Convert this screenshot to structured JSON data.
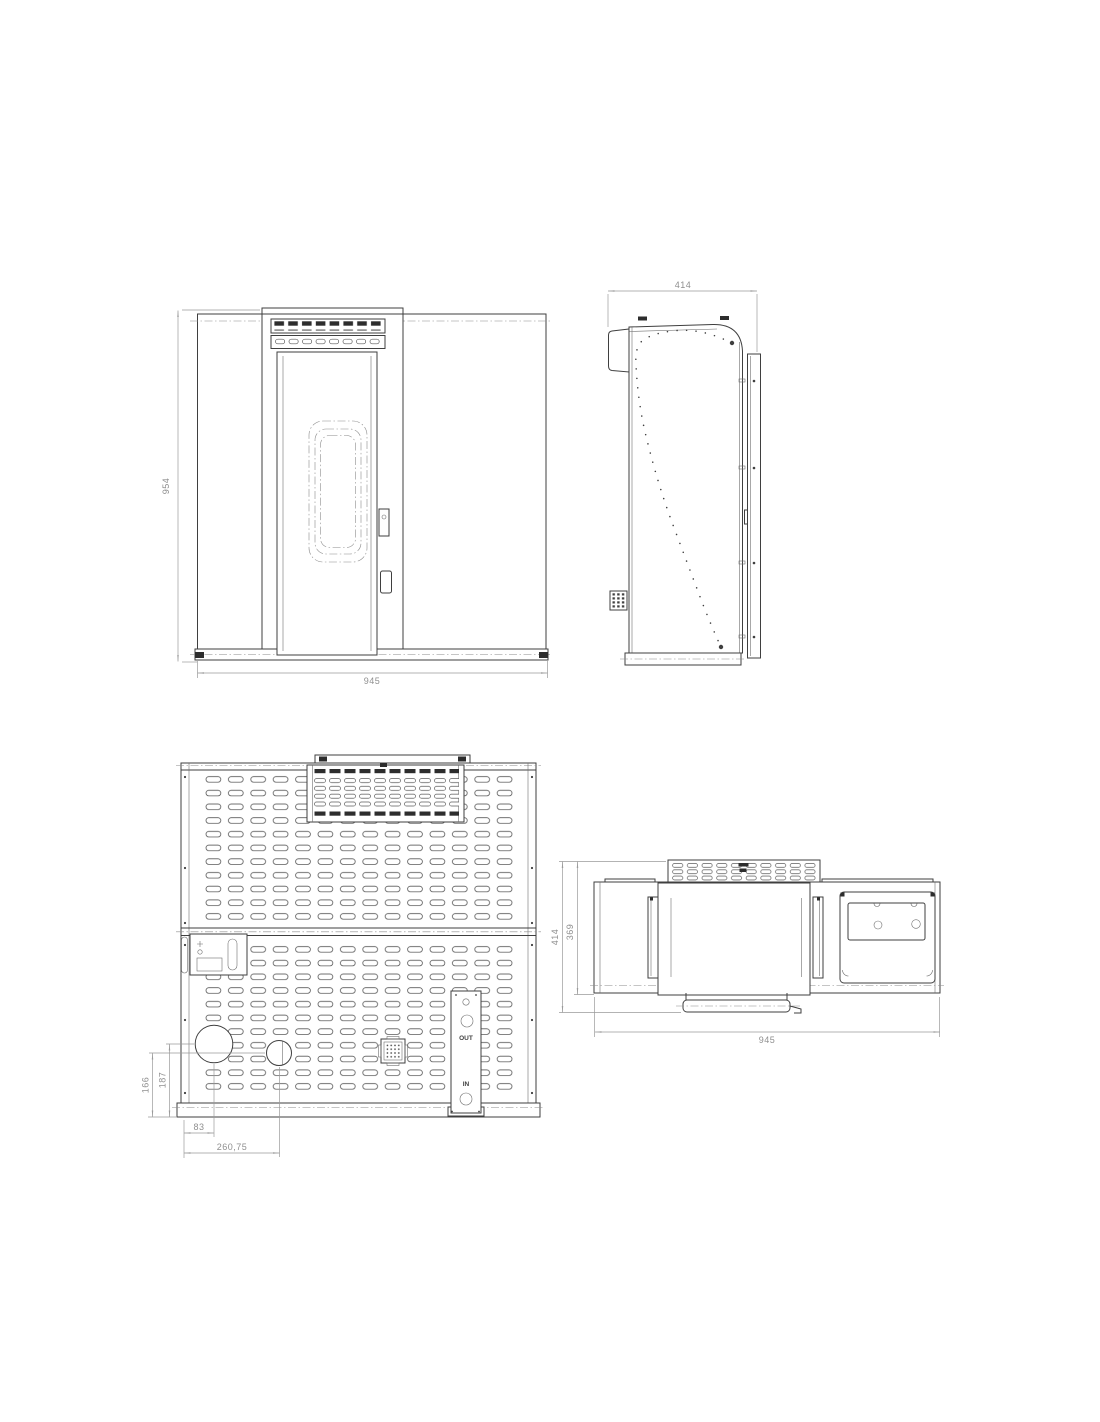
{
  "colors": {
    "line": "#3f3f3f",
    "dim": "#9a9a9a",
    "slot_dark": "#2d2d2d",
    "background": "#ffffff"
  },
  "views": {
    "front": {
      "dim_height": "954",
      "dim_width": "945"
    },
    "side": {
      "dim_depth": "414"
    },
    "rear": {
      "dim_small_port_height": "166",
      "dim_large_port_height": "187",
      "dim_large_port_offset": "83",
      "dim_small_port_offset": "260,75",
      "port_out": "OUT",
      "port_in": "IN"
    },
    "top": {
      "dim_depth_overall": "414",
      "dim_depth_body": "369",
      "dim_width": "945"
    }
  }
}
